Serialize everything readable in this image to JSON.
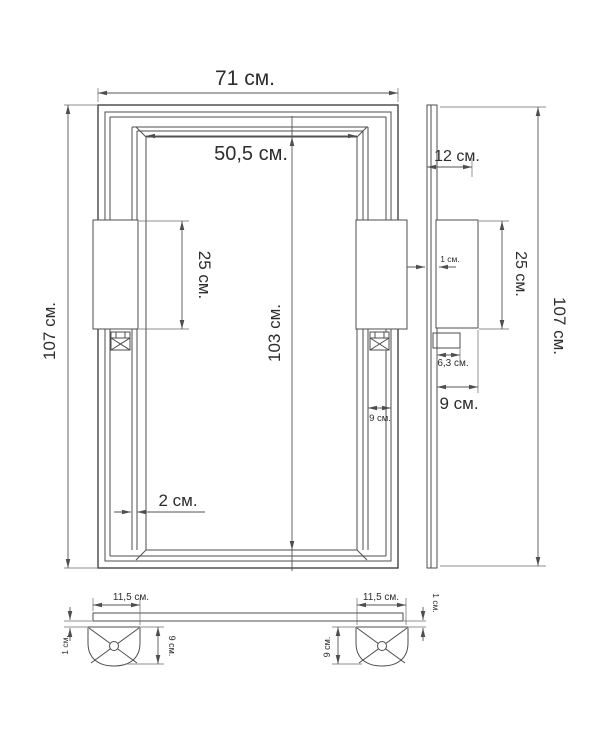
{
  "drawing": {
    "units": "см.",
    "line_color": "#4e4e4e",
    "background": "#ffffff",
    "labels": {
      "front_width": "71 см.",
      "front_opening_width": "50,5 см.",
      "front_height": "107 см.",
      "front_opening_height": "103 см.",
      "front_bracket_height": "25 см.",
      "front_profile_gap": "2 см.",
      "front_column_width": "9 см.",
      "side_depth": "12 см.",
      "side_gap": "1 см.",
      "side_bracket_height": "25 см.",
      "side_bracket_depth": "6,3 см.",
      "side_foot_depth": "9 см.",
      "side_height": "107 см.",
      "bottom_left_foot_width": "11,5 см.",
      "bottom_right_foot_width": "11,5 см.",
      "bottom_left_gap": "1 см.",
      "bottom_right_gap": "1 см.",
      "bottom_left_foot_height": "9 см.",
      "bottom_right_foot_height": "9 см."
    }
  }
}
